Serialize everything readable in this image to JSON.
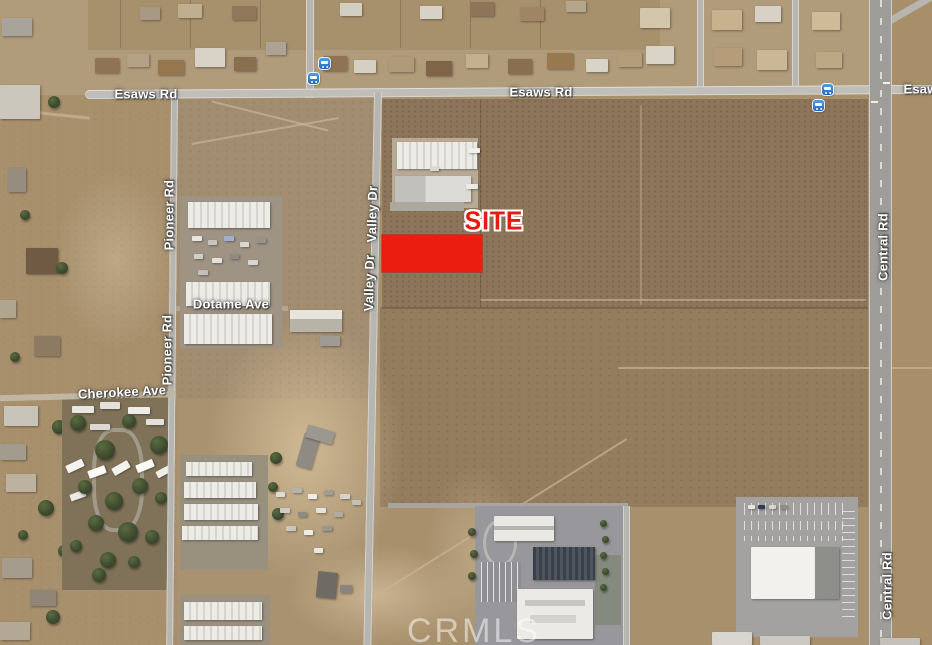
{
  "map": {
    "type": "satellite-aerial",
    "watermark": {
      "text": "CRMLS"
    },
    "annotations": {
      "site": {
        "label": "SITE",
        "color": "#e61a10",
        "marker_color": "#ea1d10"
      }
    },
    "road_labels": {
      "esaws_west": "Esaws Rd",
      "esaws_center": "Esaws Rd",
      "esaws_east": "Esaws Rd",
      "pioneer_north": "Pioneer Rd",
      "pioneer_south": "Pioneer Rd",
      "valley_north": "Valley Dr",
      "valley_south": "Valley Dr",
      "central_north": "Central Rd",
      "central_south": "Central Rd",
      "dotame": "Dotame Ave",
      "cherokee": "Cherokee Ave"
    },
    "icons": {
      "bus_stop_color": "#2f7fd6"
    }
  }
}
